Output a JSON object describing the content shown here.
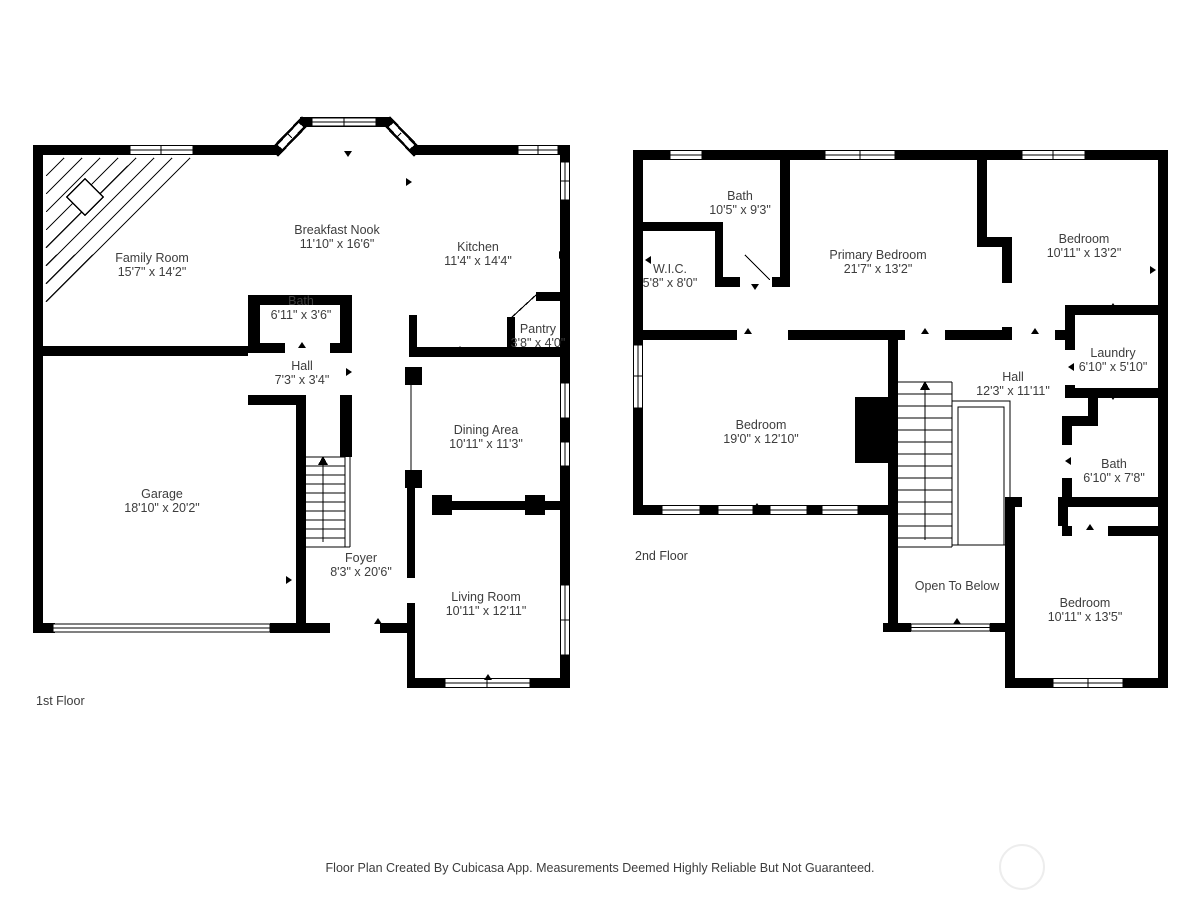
{
  "footer": {
    "text": "Floor Plan Created By Cubicasa App. Measurements Deemed Highly Reliable But Not Guaranteed."
  },
  "colors": {
    "wall": "#000000",
    "label_text": "#3d3d3d",
    "watermark_ring": "#ededed",
    "background": "#ffffff"
  },
  "floors": [
    {
      "label": "1st Floor",
      "rooms": [
        {
          "name": "Family Room",
          "dims": "15'7\" x 14'2\""
        },
        {
          "name": "Breakfast Nook",
          "dims": "11'10\" x 16'6\""
        },
        {
          "name": "Kitchen",
          "dims": "11'4\" x 14'4\""
        },
        {
          "name": "Bath",
          "dims": "6'11\" x 3'6\""
        },
        {
          "name": "Hall",
          "dims": "7'3\" x 3'4\""
        },
        {
          "name": "Pantry",
          "dims": "3'8\" x 4'0\""
        },
        {
          "name": "Dining Area",
          "dims": "10'11\" x 11'3\""
        },
        {
          "name": "Garage",
          "dims": "18'10\" x 20'2\""
        },
        {
          "name": "Foyer",
          "dims": "8'3\" x 20'6\""
        },
        {
          "name": "Living Room",
          "dims": "10'11\" x 12'11\""
        }
      ]
    },
    {
      "label": "2nd Floor",
      "rooms": [
        {
          "name": "Bath",
          "dims": "10'5\" x 9'3\""
        },
        {
          "name": "W.I.C.",
          "dims": "5'8\" x 8'0\""
        },
        {
          "name": "Primary Bedroom",
          "dims": "21'7\" x 13'2\""
        },
        {
          "name": "Bedroom",
          "dims": "10'11\" x 13'2\""
        },
        {
          "name": "Laundry",
          "dims": "6'10\" x 5'10\""
        },
        {
          "name": "Hall",
          "dims": "12'3\" x 11'11\""
        },
        {
          "name": "Bath",
          "dims": "6'10\" x 7'8\""
        },
        {
          "name": "Bedroom",
          "dims": "19'0\" x 12'10\""
        },
        {
          "name": "Open To Below",
          "dims": ""
        },
        {
          "name": "Bedroom",
          "dims": "10'11\" x 13'5\""
        }
      ]
    }
  ]
}
